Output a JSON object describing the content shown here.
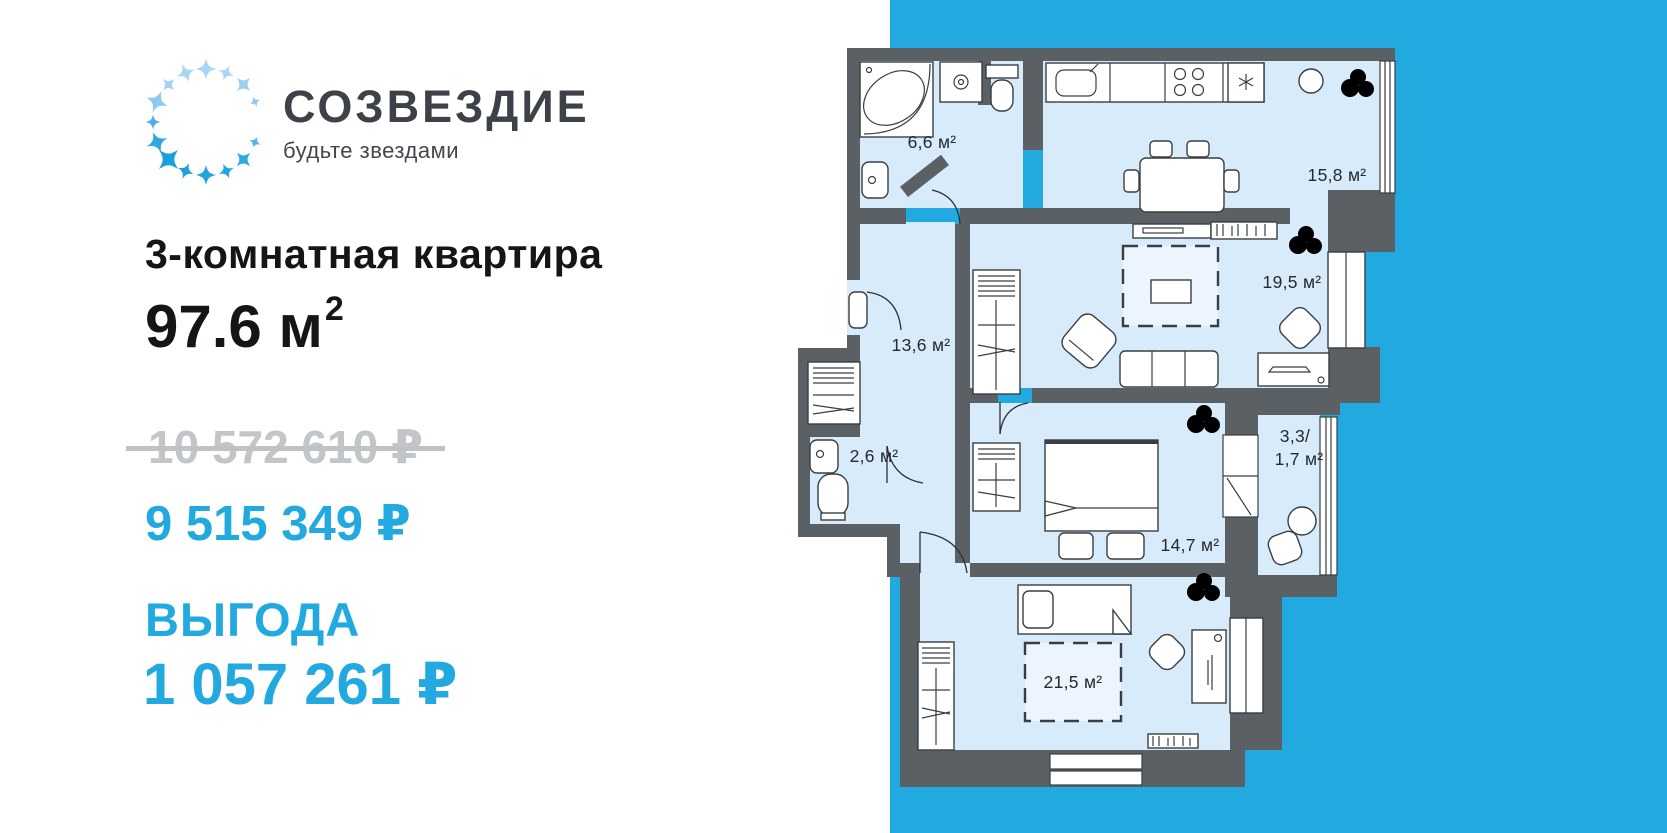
{
  "brand": {
    "name": "СОЗВЕЗДИЕ",
    "tagline": "будьте звездами"
  },
  "listing": {
    "title": "3-комнатная квартира",
    "area_value": "97.6 м",
    "area_sup": "2",
    "old_price": "10 572 610 ₽",
    "new_price": "9 515 349 ₽",
    "benefit_label": "ВЫГОДА",
    "benefit_value": "1 057 261 ₽"
  },
  "floorplan": {
    "rooms": [
      {
        "id": "bathroom",
        "label": "6,6 м²"
      },
      {
        "id": "kitchen",
        "label": "15,8 м²"
      },
      {
        "id": "living",
        "label": "19,5 м²"
      },
      {
        "id": "hallway",
        "label": "13,6 м²"
      },
      {
        "id": "wc",
        "label": "2,6 м²"
      },
      {
        "id": "bedroom",
        "label": "14,7 м²"
      },
      {
        "id": "balcony",
        "label_line1": "3,3/",
        "label_line2": "1,7 м²"
      },
      {
        "id": "bedroom-2",
        "label": "21,5 м²"
      }
    ]
  },
  "colors": {
    "accent_blue": "#21a9e0",
    "wall_gray": "#5b6065",
    "room_blue": "#d7ebfa",
    "old_price_gray": "#c3c6c9",
    "text_dark": "#141517",
    "logo_text": "#3d4248"
  }
}
